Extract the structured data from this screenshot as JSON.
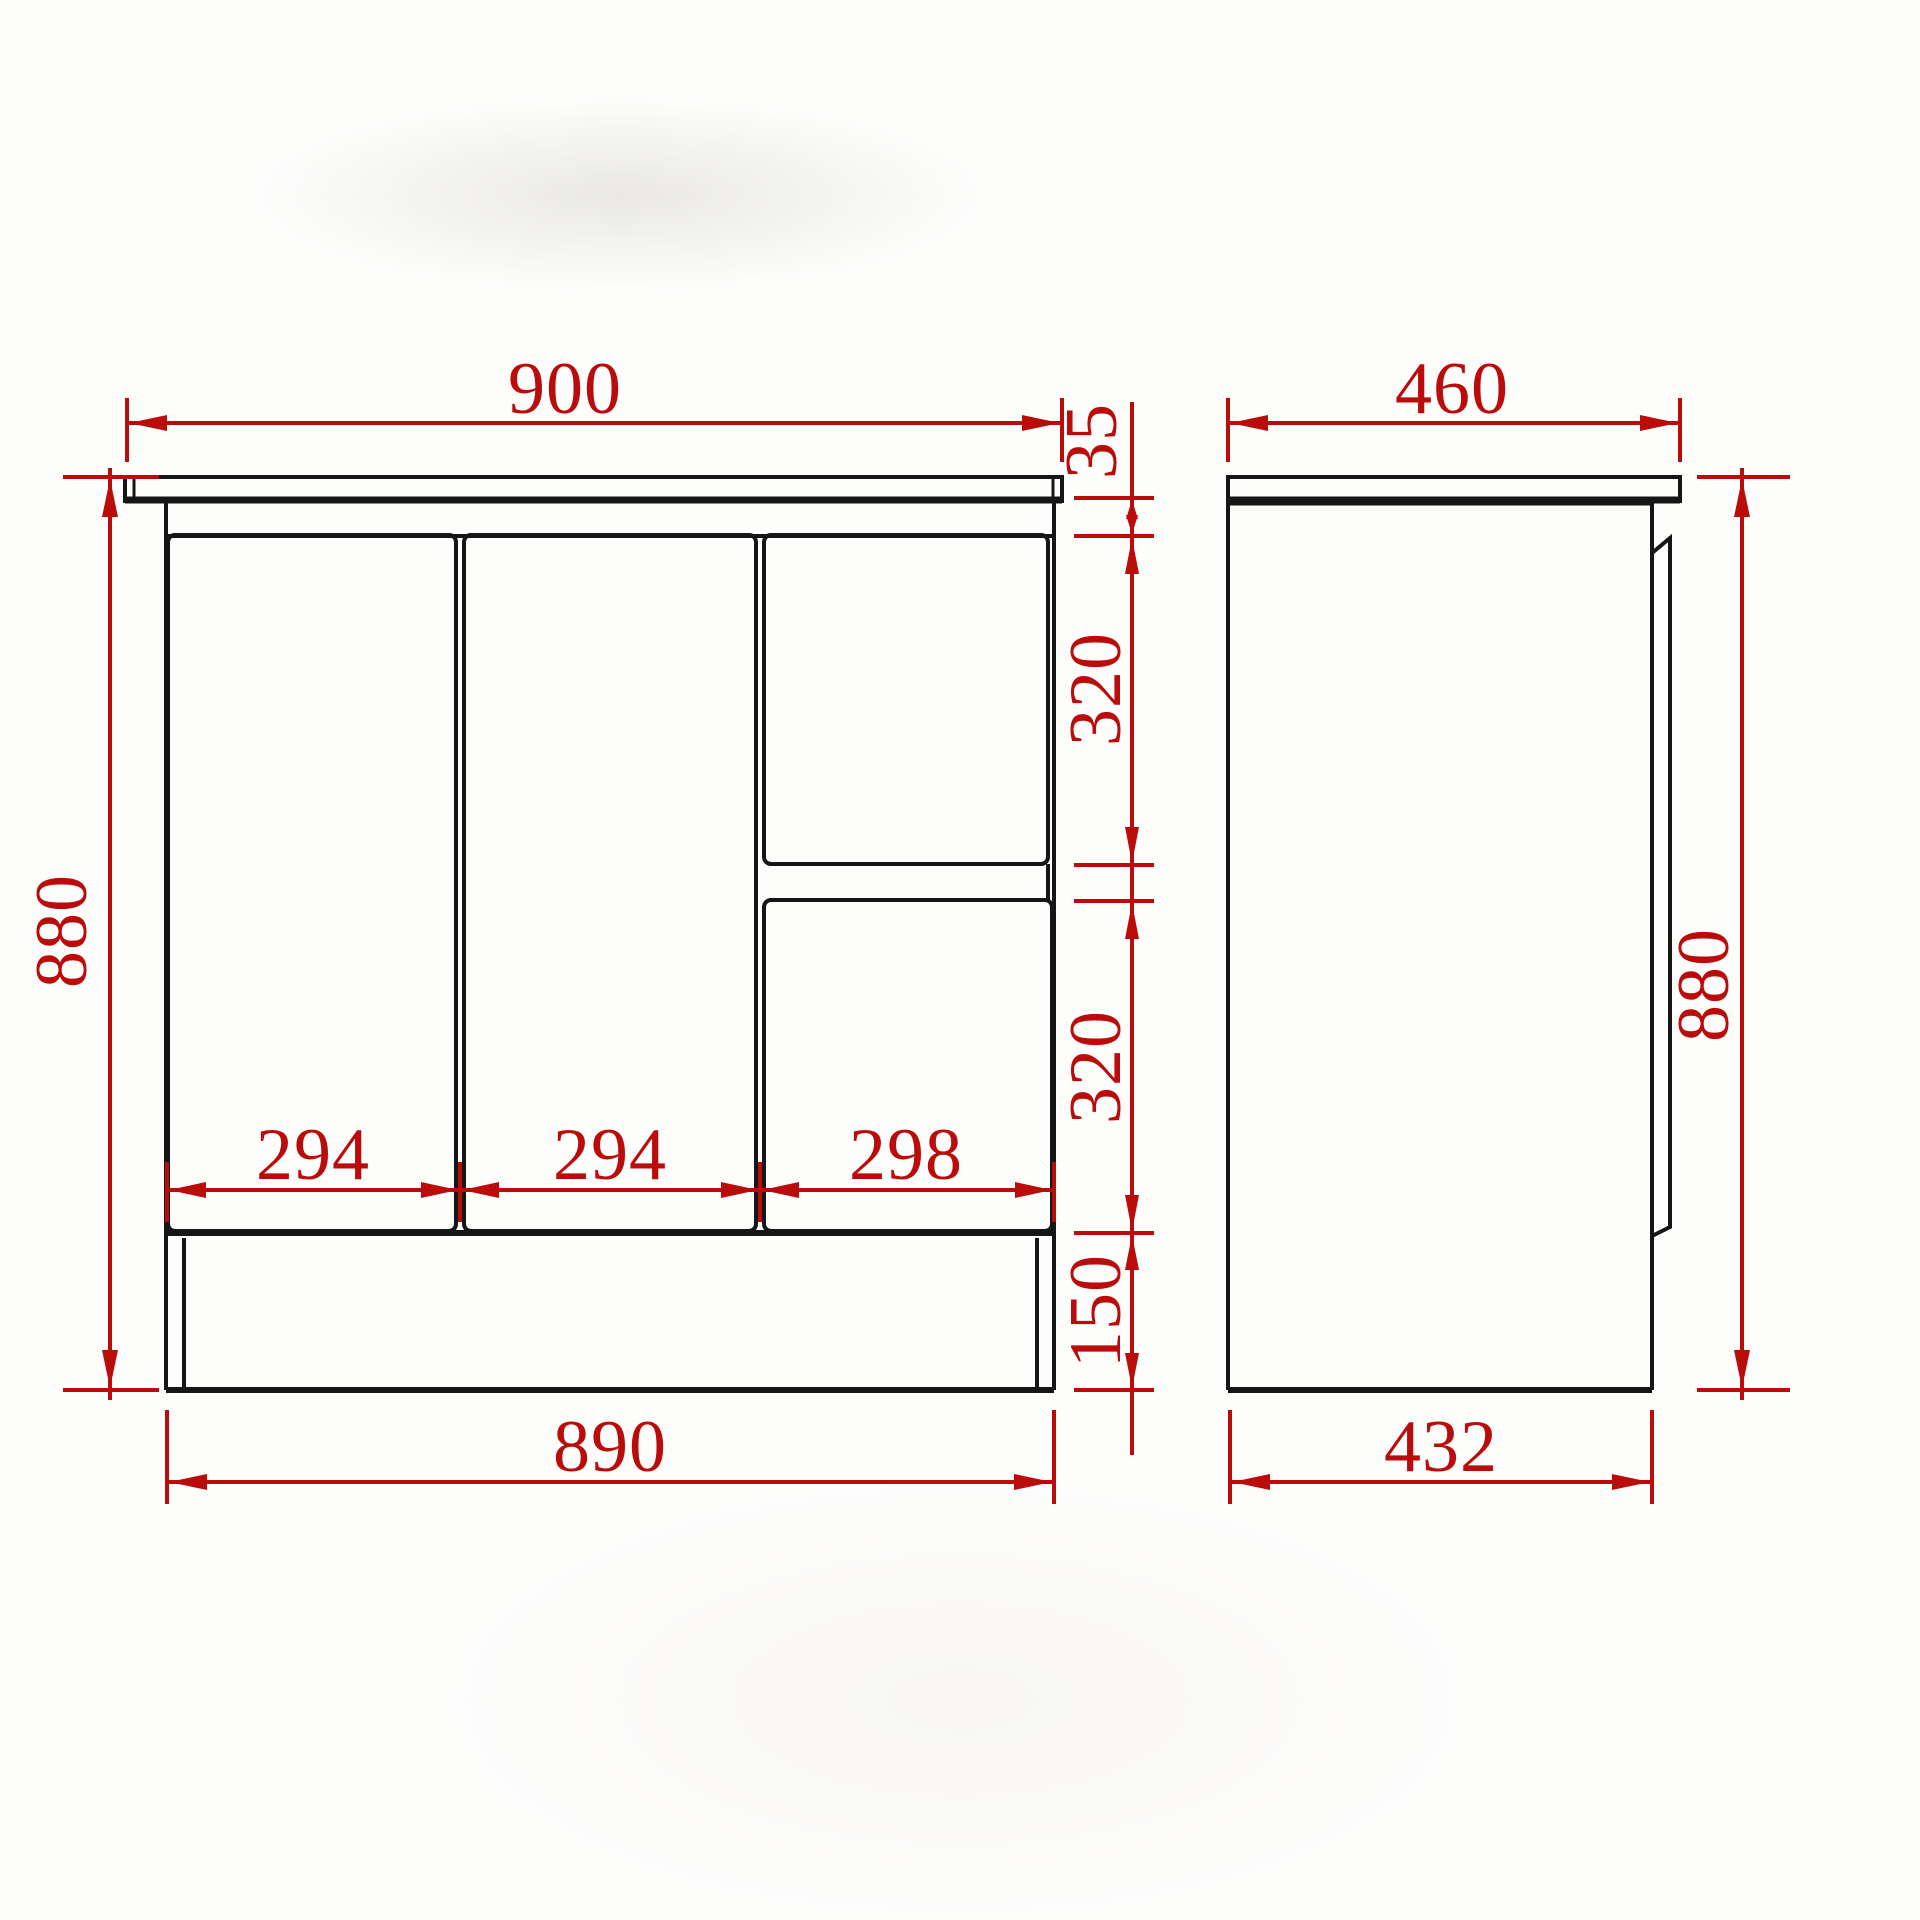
{
  "drawing": {
    "type": "cabinet-dimension-drawing",
    "colors": {
      "dimension_red": "#bb0c0c",
      "line_black": "#161616",
      "background": "#fdfdfc"
    },
    "front_view": {
      "top_width": "900",
      "overall_height": "880",
      "top_rail_height": "35",
      "upper_section_height": "320",
      "lower_section_height": "320",
      "kickboard_height": "150",
      "bottom_width": "890",
      "panel_widths": [
        "294",
        "294",
        "298"
      ]
    },
    "side_view": {
      "top_depth": "460",
      "overall_height": "880",
      "bottom_depth": "432"
    }
  }
}
